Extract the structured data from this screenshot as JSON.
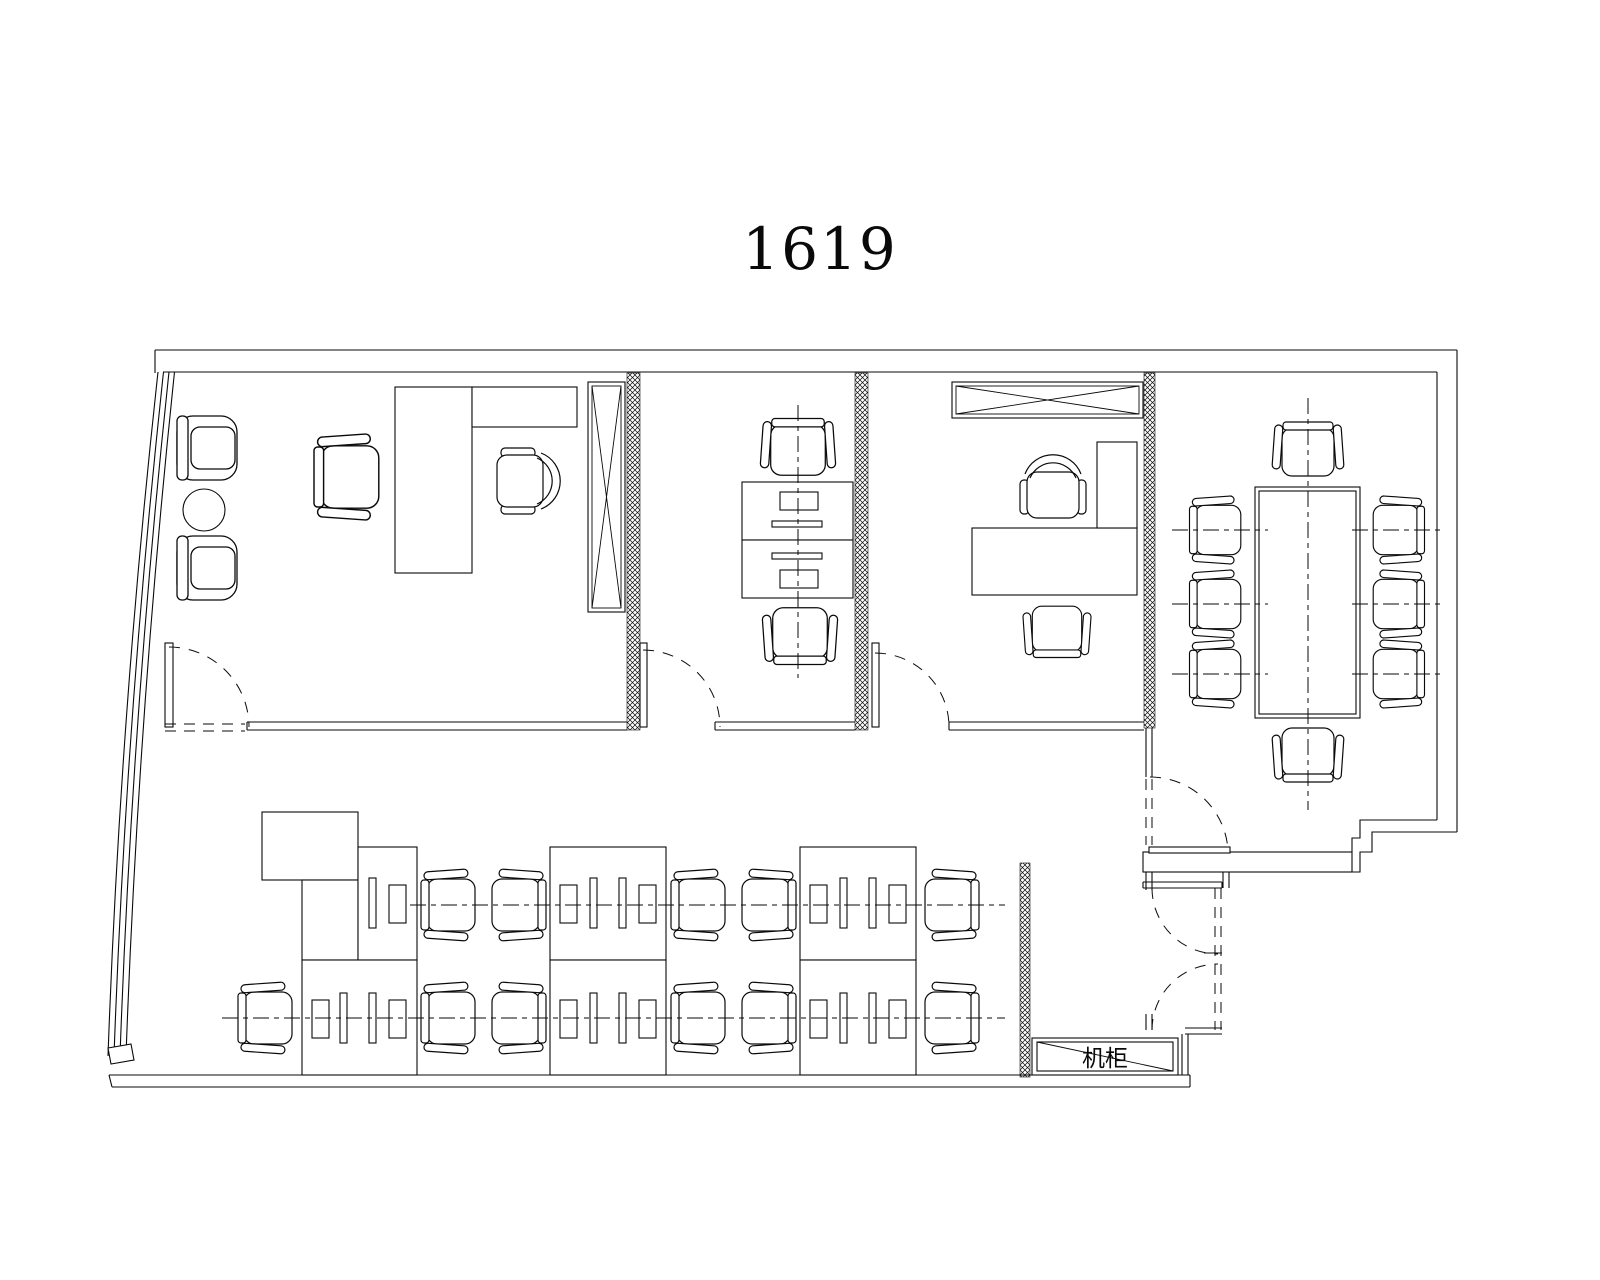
{
  "title": {
    "text": "1619"
  },
  "labels": [
    {
      "text": "机柜",
      "x": 1105,
      "y": 1066,
      "size": 23
    }
  ],
  "plan": {
    "width": 1600,
    "height": 1280,
    "ink": "#0a0a0a",
    "paper": "#ffffff",
    "hatches": [
      [
        627,
        373,
        13,
        357
      ],
      [
        855,
        373,
        13,
        357
      ],
      [
        1144,
        373,
        11,
        355
      ],
      [
        1020,
        863,
        10,
        214
      ]
    ],
    "lines": [
      [
        155,
        350,
        1457,
        350
      ],
      [
        163,
        372,
        1437,
        372
      ],
      [
        155,
        350,
        155,
        373
      ],
      [
        1457,
        350,
        1457,
        832
      ],
      [
        1437,
        372,
        1437,
        820
      ],
      [
        247,
        722,
        627,
        722
      ],
      [
        247,
        730,
        627,
        730
      ],
      [
        247,
        722,
        247,
        730
      ],
      [
        715,
        722,
        855,
        722
      ],
      [
        715,
        730,
        855,
        730
      ],
      [
        715,
        722,
        715,
        730
      ],
      [
        949,
        722,
        1144,
        722
      ],
      [
        949,
        730,
        1144,
        730
      ],
      [
        949,
        722,
        949,
        730
      ],
      [
        1146,
        728,
        1146,
        777
      ],
      [
        1152,
        728,
        1152,
        777
      ],
      [
        1143,
        882,
        1222,
        882
      ],
      [
        1143,
        888,
        1222,
        888
      ],
      [
        1143,
        882,
        1143,
        888
      ],
      [
        1222,
        882,
        1222,
        888
      ],
      [
        1146,
        872,
        1146,
        890
      ],
      [
        1152,
        872,
        1152,
        890
      ],
      [
        1146,
        1014,
        1146,
        1030
      ],
      [
        1152,
        1014,
        1152,
        1030
      ],
      [
        1223,
        848,
        1223,
        888
      ],
      [
        1229,
        848,
        1229,
        888
      ],
      [
        1185,
        1028,
        1222,
        1028
      ],
      [
        1185,
        1034,
        1222,
        1034
      ],
      [
        1182,
        1034,
        1182,
        1075
      ],
      [
        1188,
        1034,
        1188,
        1075
      ],
      [
        109,
        1075,
        1190,
        1075
      ],
      [
        112,
        1087,
        1190,
        1087
      ],
      [
        1190,
        1075,
        1190,
        1087
      ],
      [
        109,
        1075,
        112,
        1087
      ],
      [
        608,
        847,
        608,
        960
      ],
      [
        858,
        847,
        858,
        960
      ],
      [
        358,
        960,
        358,
        1075
      ],
      [
        608,
        960,
        608,
        1075
      ],
      [
        858,
        960,
        858,
        1075
      ]
    ],
    "paths": [
      {
        "d": "M158,372 Q120,718 108,1056"
      },
      {
        "d": "M163.5,372 Q126,718 114,1056"
      },
      {
        "d": "M169,372 Q132,718 120,1056"
      },
      {
        "d": "M174.5,372 Q138,718 126,1056"
      },
      {
        "d": "M1437,820 H1360 V838 H1352 V852"
      },
      {
        "d": "M1457,832 H1372 V852 H1360 V872 H1352"
      },
      {
        "d": "M108,1048 L131,1044 L134,1060 L111,1064 Z",
        "f": 1
      }
    ],
    "rects": [
      [
        1143,
        852,
        209,
        20,
        "wall-band"
      ],
      [
        395,
        387,
        77,
        186,
        "desk"
      ],
      [
        472,
        387,
        105,
        40,
        "desk"
      ],
      [
        742,
        482,
        111,
        58,
        "desk"
      ],
      [
        742,
        540,
        111,
        58,
        "desk"
      ],
      [
        972,
        528,
        165,
        67,
        "desk"
      ],
      [
        1097,
        442,
        40,
        86,
        "desk-return"
      ],
      [
        1255,
        487,
        105,
        231,
        "conference-table"
      ],
      [
        1259,
        491,
        97,
        223,
        "conference-table-inner"
      ],
      [
        262,
        812,
        96,
        68,
        "cabinet"
      ],
      [
        302,
        880,
        56,
        80,
        "desk"
      ],
      [
        358,
        847,
        59,
        113,
        "desk"
      ],
      [
        550,
        847,
        116,
        113,
        "desk"
      ],
      [
        800,
        847,
        116,
        113,
        "desk"
      ],
      [
        302,
        960,
        115,
        115,
        "desk"
      ],
      [
        550,
        960,
        116,
        115,
        "desk"
      ],
      [
        800,
        960,
        116,
        115,
        "desk"
      ],
      [
        369,
        878,
        7,
        50,
        "monitor"
      ],
      [
        389,
        885,
        17,
        38,
        "keyboard"
      ],
      [
        560,
        885,
        17,
        38,
        "keyboard"
      ],
      [
        590,
        878,
        7,
        50,
        "monitor"
      ],
      [
        619,
        878,
        7,
        50,
        "monitor"
      ],
      [
        639,
        885,
        17,
        38,
        "keyboard"
      ],
      [
        810,
        885,
        17,
        38,
        "keyboard"
      ],
      [
        840,
        878,
        7,
        50,
        "monitor"
      ],
      [
        869,
        878,
        7,
        50,
        "monitor"
      ],
      [
        889,
        885,
        17,
        38,
        "keyboard"
      ],
      [
        312,
        1000,
        17,
        38,
        "keyboard"
      ],
      [
        340,
        993,
        7,
        50,
        "monitor"
      ],
      [
        369,
        993,
        7,
        50,
        "monitor"
      ],
      [
        389,
        1000,
        17,
        38,
        "keyboard"
      ],
      [
        560,
        1000,
        17,
        38,
        "keyboard"
      ],
      [
        590,
        993,
        7,
        50,
        "monitor"
      ],
      [
        619,
        993,
        7,
        50,
        "monitor"
      ],
      [
        639,
        1000,
        17,
        38,
        "keyboard"
      ],
      [
        810,
        1000,
        17,
        38,
        "keyboard"
      ],
      [
        840,
        993,
        7,
        50,
        "monitor"
      ],
      [
        869,
        993,
        7,
        50,
        "monitor"
      ],
      [
        889,
        1000,
        17,
        38,
        "keyboard"
      ],
      [
        780,
        492,
        38,
        18,
        "monitor"
      ],
      [
        772,
        521,
        50,
        6,
        "keyboard"
      ],
      [
        772,
        553,
        50,
        6,
        "keyboard"
      ],
      [
        780,
        570,
        38,
        18,
        "monitor"
      ],
      [
        165,
        643,
        8,
        84,
        "door-leaf"
      ],
      [
        640,
        643,
        7,
        84,
        "door-leaf"
      ],
      [
        872,
        643,
        7,
        84,
        "door-leaf"
      ],
      [
        1149,
        847,
        81,
        6,
        "door-leaf"
      ],
      [
        1032,
        1038,
        146,
        37,
        "server-cabinet"
      ],
      [
        1037,
        1042,
        136,
        29,
        "server-cabinet-inner"
      ]
    ],
    "lines2": [
      [
        1037,
        1042,
        1173,
        1071
      ],
      [
        1204,
        953,
        1222,
        953
      ]
    ],
    "xboxes": [
      [
        588,
        382,
        37,
        230
      ],
      [
        952,
        382,
        191,
        36
      ]
    ],
    "circles": [
      [
        204,
        510,
        21
      ]
    ],
    "chairs": [
      [
        "arm",
        207,
        448,
        0,
        1
      ],
      [
        "arm",
        207,
        568,
        0,
        1
      ],
      [
        "task",
        350,
        477,
        0,
        1.2
      ],
      [
        "exec",
        525,
        481,
        0,
        1
      ],
      [
        "task",
        798,
        450,
        90,
        1.05
      ],
      [
        "task",
        800,
        633,
        -90,
        1.05
      ],
      [
        "exec",
        1053,
        490,
        -90,
        1
      ],
      [
        "task",
        1057,
        629,
        -90,
        0.95
      ],
      [
        "task",
        1308,
        452,
        90,
        1
      ],
      [
        "task",
        1308,
        752,
        -90,
        1
      ],
      [
        "task",
        1218,
        530,
        0,
        0.95
      ],
      [
        "task",
        1218,
        604,
        0,
        0.95
      ],
      [
        "task",
        1218,
        674,
        0,
        0.95
      ],
      [
        "task",
        1396,
        530,
        180,
        0.95
      ],
      [
        "task",
        1396,
        604,
        180,
        0.95
      ],
      [
        "task",
        1396,
        674,
        180,
        0.95
      ],
      [
        "task",
        451,
        905,
        0,
        1
      ],
      [
        "task",
        516,
        905,
        180,
        1
      ],
      [
        "task",
        701,
        905,
        0,
        1
      ],
      [
        "task",
        766,
        905,
        180,
        1
      ],
      [
        "task",
        949,
        905,
        180,
        1
      ],
      [
        "task",
        268,
        1018,
        0,
        1
      ],
      [
        "task",
        451,
        1018,
        0,
        1
      ],
      [
        "task",
        516,
        1018,
        180,
        1
      ],
      [
        "task",
        701,
        1018,
        0,
        1
      ],
      [
        "task",
        766,
        1018,
        180,
        1
      ],
      [
        "task",
        949,
        1018,
        180,
        1
      ]
    ],
    "dashed": [
      [
        165,
        724,
        245,
        724
      ],
      [
        165,
        731,
        245,
        731
      ],
      [
        1146,
        779,
        1146,
        845
      ],
      [
        1152,
        779,
        1152,
        845
      ],
      [
        1215,
        888,
        1215,
        1030
      ],
      [
        1221,
        888,
        1221,
        1030
      ]
    ],
    "centerlines": [
      [
        798,
        405,
        798,
        678
      ],
      [
        1308,
        398,
        1308,
        810
      ],
      [
        1172,
        530,
        1268,
        530
      ],
      [
        1172,
        604,
        1268,
        604
      ],
      [
        1172,
        674,
        1268,
        674
      ],
      [
        1352,
        530,
        1442,
        530
      ],
      [
        1352,
        604,
        1442,
        604
      ],
      [
        1352,
        674,
        1442,
        674
      ],
      [
        410,
        905,
        1005,
        905
      ],
      [
        222,
        1018,
        1005,
        1018
      ]
    ],
    "arcs": [
      {
        "d": "M169,647 A80,80 0 0 1 249,727"
      },
      {
        "d": "M643,650 A77,77 0 0 1 720,727"
      },
      {
        "d": "M875,653 A74,74 0 0 1 949,727"
      },
      {
        "d": "M1150,777 A78,78 0 0 1 1228,850"
      },
      {
        "d": "M1152,888 A66,66 0 0 0 1218,954"
      },
      {
        "d": "M1152,1030 A66,66 0 0 1 1218,964"
      }
    ]
  }
}
